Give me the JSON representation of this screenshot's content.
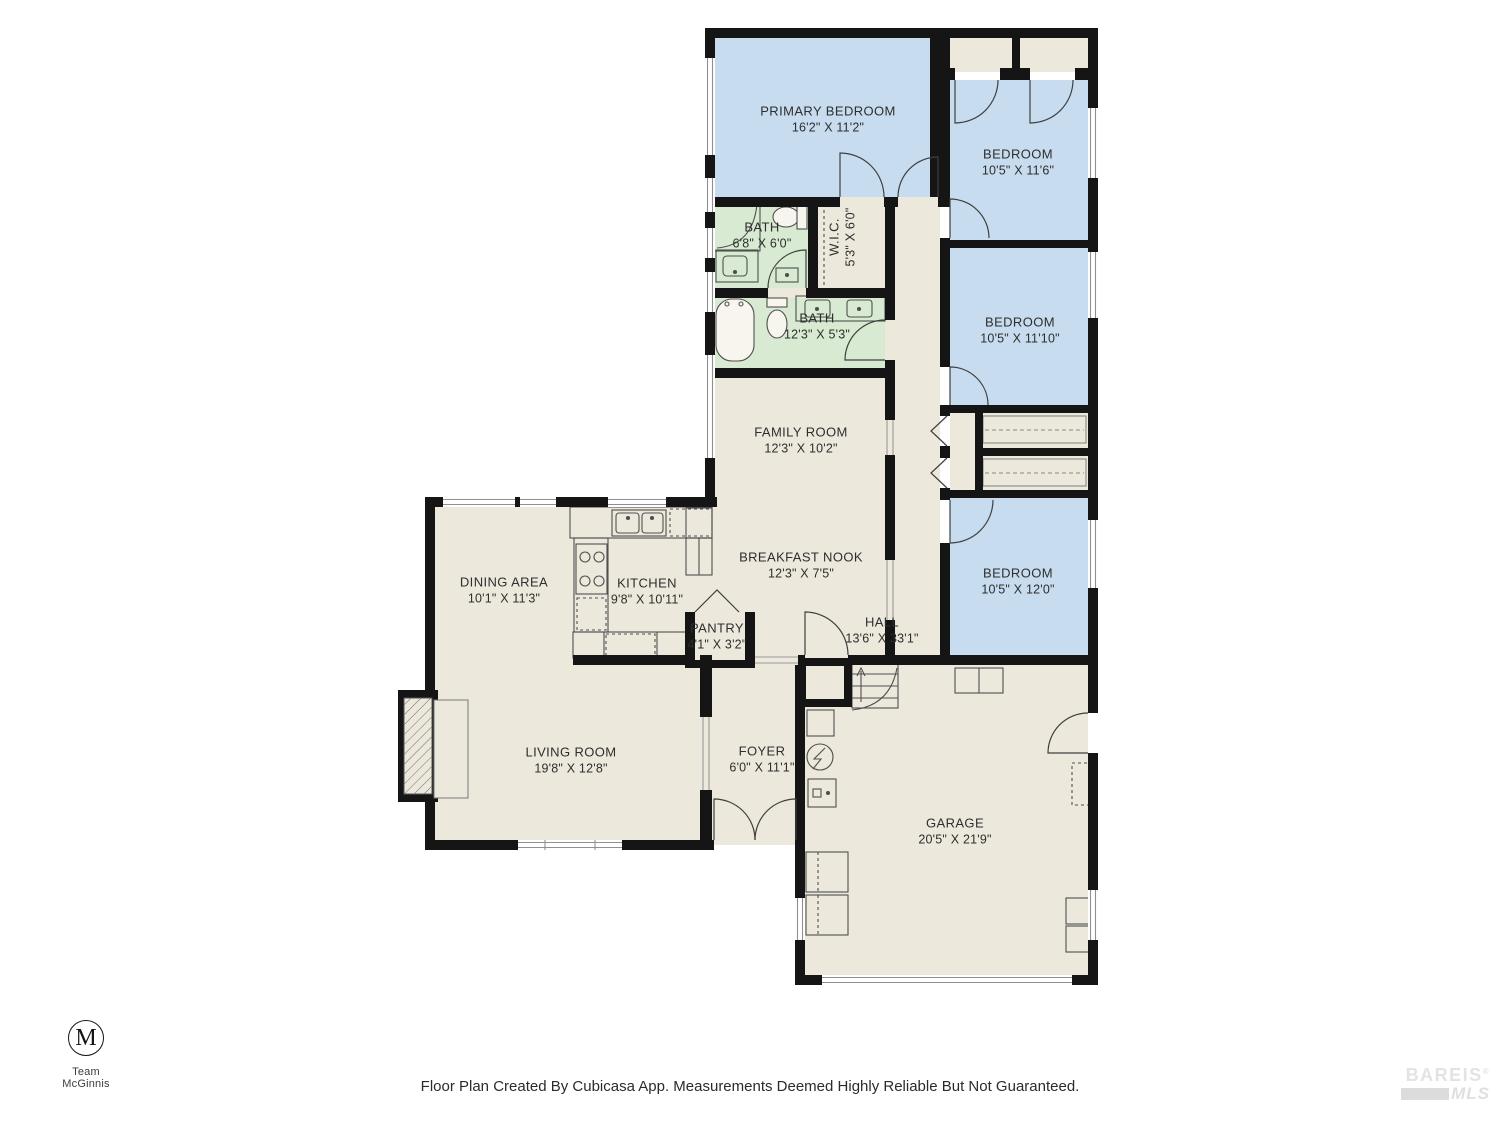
{
  "colors": {
    "floor": "#ece8dc",
    "bedroom_fill": "#c7dcef",
    "bath_fill": "#d8ead2",
    "wall": "#151515",
    "label_text": "#2e2e2e"
  },
  "rooms": [
    {
      "id": "primary-bedroom",
      "name": "PRIMARY BEDROOM",
      "dims": "16'2\" X 11'2\""
    },
    {
      "id": "bedroom-1",
      "name": "BEDROOM",
      "dims": "10'5\" X 11'6\""
    },
    {
      "id": "bath-1",
      "name": "BATH",
      "dims": "6'8\" X 6'0\""
    },
    {
      "id": "wic",
      "name": "W.I.C.",
      "dims": "5'3\" X 6'0\""
    },
    {
      "id": "bath-2",
      "name": "BATH",
      "dims": "12'3\" X 5'3\""
    },
    {
      "id": "bedroom-2",
      "name": "BEDROOM",
      "dims": "10'5\" X 11'10\""
    },
    {
      "id": "family-room",
      "name": "FAMILY ROOM",
      "dims": "12'3\" X 10'2\""
    },
    {
      "id": "breakfast-nook",
      "name": "BREAKFAST NOOK",
      "dims": "12'3\" X 7'5\""
    },
    {
      "id": "dining-area",
      "name": "DINING AREA",
      "dims": "10'1\" X 11'3\""
    },
    {
      "id": "kitchen",
      "name": "KITCHEN",
      "dims": "9'8\" X 10'11\""
    },
    {
      "id": "pantry",
      "name": "PANTRY",
      "dims": "4'1\" X 3'2\""
    },
    {
      "id": "hall",
      "name": "HALL",
      "dims": "13'6\" X 33'1\""
    },
    {
      "id": "bedroom-3",
      "name": "BEDROOM",
      "dims": "10'5\" X 12'0\""
    },
    {
      "id": "living-room",
      "name": "LIVING ROOM",
      "dims": "19'8\" X 12'8\""
    },
    {
      "id": "foyer",
      "name": "FOYER",
      "dims": "6'0\" X 11'1\""
    },
    {
      "id": "garage",
      "name": "GARAGE",
      "dims": "20'5\" X 21'9\""
    }
  ],
  "fixtures": [
    "shower-icon",
    "toilet-icon",
    "bathroom-sink-icon",
    "bathtub-icon",
    "double-vanity-icon",
    "kitchen-sink-icon",
    "stove-icon",
    "refrigerator-icon",
    "dishwasher-icon",
    "stairs-icon",
    "water-heater-icon",
    "electrical-panel-icon",
    "washer-dryer-icon",
    "fireplace-icon",
    "closet-shelves",
    "garage-door"
  ],
  "branding": {
    "team_logo_letter": "M",
    "team_name": "Team McGinnis",
    "mls_line1": "BAREIS",
    "mls_reg": "®",
    "mls_line2": "MLS"
  },
  "footer": {
    "disclaimer": "Floor Plan Created By Cubicasa App. Measurements Deemed Highly Reliable But Not Guaranteed."
  }
}
